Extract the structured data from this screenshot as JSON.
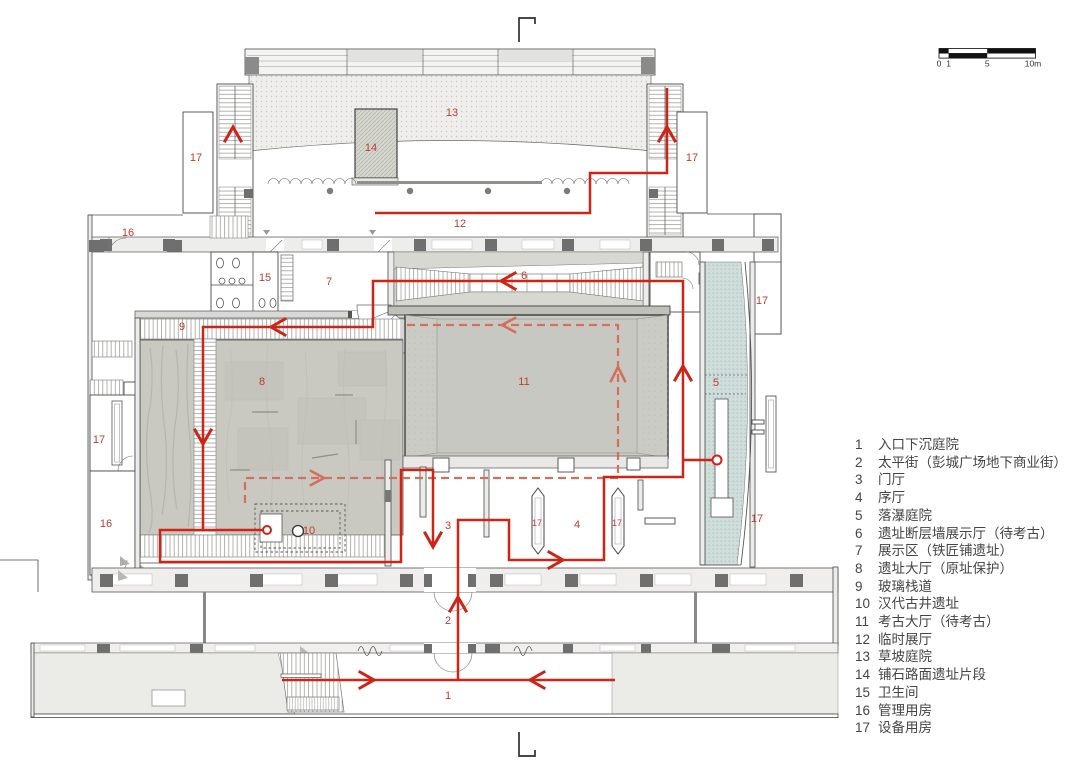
{
  "colors": {
    "route": "#cd2418",
    "route_dashed": "#d2705b",
    "room_label": "#bf3b2e"
  },
  "scale_bar": {
    "ticks": [
      "0",
      "1",
      "5",
      "10m"
    ]
  },
  "legend": {
    "items": [
      {
        "num": "1",
        "label": "入口下沉庭院"
      },
      {
        "num": "2",
        "label": "太平街（彭城广场地下商业街）"
      },
      {
        "num": "3",
        "label": "门厅"
      },
      {
        "num": "4",
        "label": "序厅"
      },
      {
        "num": "5",
        "label": "落瀑庭院"
      },
      {
        "num": "6",
        "label": "遗址断层墙展示厅（待考古）"
      },
      {
        "num": "7",
        "label": "展示区（铁匠铺遗址）"
      },
      {
        "num": "8",
        "label": "遗址大厅（原址保护）"
      },
      {
        "num": "9",
        "label": "玻璃栈道"
      },
      {
        "num": "10",
        "label": "汉代古井遗址"
      },
      {
        "num": "11",
        "label": "考古大厅（待考古）"
      },
      {
        "num": "12",
        "label": "临时展厅"
      },
      {
        "num": "13",
        "label": "草坡庭院"
      },
      {
        "num": "14",
        "label": "铺石路面遗址片段"
      },
      {
        "num": "15",
        "label": "卫生间"
      },
      {
        "num": "16",
        "label": "管理用房"
      },
      {
        "num": "17",
        "label": "设备用房"
      }
    ]
  },
  "room_labels": [
    {
      "t": "13",
      "x": 452,
      "y": 113
    },
    {
      "t": "14",
      "x": 371,
      "y": 148
    },
    {
      "t": "17",
      "x": 196,
      "y": 158
    },
    {
      "t": "17",
      "x": 692,
      "y": 158
    },
    {
      "t": "12",
      "x": 460,
      "y": 224
    },
    {
      "t": "16",
      "x": 128,
      "y": 233
    },
    {
      "t": "15",
      "x": 265,
      "y": 278
    },
    {
      "t": "7",
      "x": 329,
      "y": 282
    },
    {
      "t": "6",
      "x": 524,
      "y": 276
    },
    {
      "t": "17",
      "x": 762,
      "y": 301
    },
    {
      "t": "9",
      "x": 182,
      "y": 327
    },
    {
      "t": "8",
      "x": 262,
      "y": 382
    },
    {
      "t": "11",
      "x": 524,
      "y": 382
    },
    {
      "t": "5",
      "x": 716,
      "y": 383
    },
    {
      "t": "17",
      "x": 99,
      "y": 440
    },
    {
      "t": "10",
      "x": 309,
      "y": 531
    },
    {
      "t": "3",
      "x": 448,
      "y": 526
    },
    {
      "t": "17",
      "x": 537,
      "y": 523,
      "s": 1
    },
    {
      "t": "4",
      "x": 577,
      "y": 525
    },
    {
      "t": "17",
      "x": 617,
      "y": 523,
      "s": 1
    },
    {
      "t": "17",
      "x": 757,
      "y": 519
    },
    {
      "t": "16",
      "x": 106,
      "y": 524
    },
    {
      "t": "2",
      "x": 448,
      "y": 621
    },
    {
      "t": "1",
      "x": 448,
      "y": 696
    }
  ]
}
